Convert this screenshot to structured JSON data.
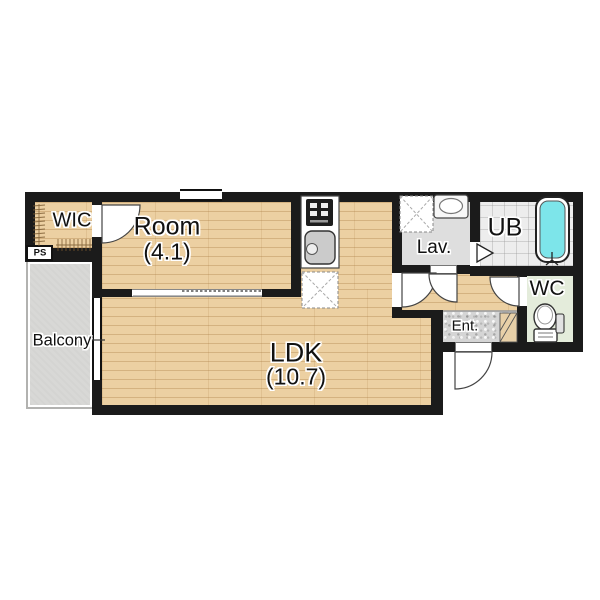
{
  "title": "1LDK apartment floor plan",
  "rooms": {
    "wic": {
      "label": "WIC"
    },
    "ps": {
      "label": "PS"
    },
    "room": {
      "label": "Room",
      "size": "(4.1)"
    },
    "ldk": {
      "label": "LDK",
      "size": "(10.7)"
    },
    "balcony": {
      "label": "Balcony"
    },
    "lav": {
      "label": "Lav."
    },
    "ub": {
      "label": "UB"
    },
    "wc": {
      "label": "WC"
    },
    "ent": {
      "label": "Ent."
    }
  },
  "fixtures": [
    "stove-icon",
    "kitchen-sink-icon",
    "refrigerator-space",
    "washing-machine-space",
    "washbasin-icon",
    "bathtub-icon",
    "toilet-icon",
    "hanger-pipe-icon",
    "shoe-cabinet",
    "door-swing-arc",
    "folding-door-icon",
    "sliding-door-opening",
    "window"
  ],
  "colors": {
    "wall": "#1b1b1b",
    "wood_floor": "#ecd0a2",
    "balcony_floor": "#d8d8d6",
    "lav_floor": "#dedede",
    "ub_floor": "#ededed",
    "wc_floor": "#e4ecdb",
    "ent_floor": "#d5d5d5",
    "bathtub": "#7de5ea"
  }
}
